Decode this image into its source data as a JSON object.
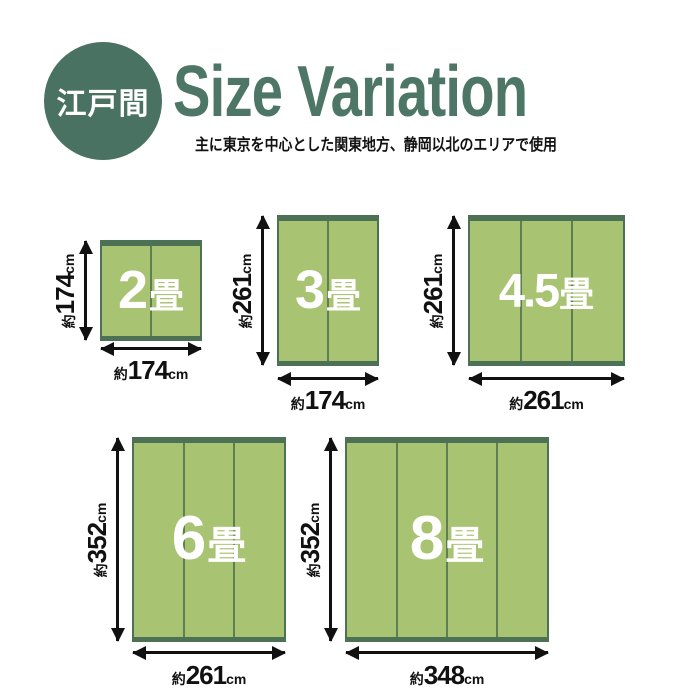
{
  "header": {
    "badge": "江戸間",
    "title": "Size Variation",
    "subtitle": "主に東京を中心とした関東地方、静岡以北のエリアで使用"
  },
  "colors": {
    "brand_green": "#4a7263",
    "title_green": "#4d7667",
    "mat_fill": "#a8c371",
    "mat_border": "#4d7154",
    "mat_divider": "#5f7f52",
    "dimension_text": "#111111",
    "mat_label_text": "#ffffff",
    "background": "#ffffff"
  },
  "mats": [
    {
      "name": "2畳",
      "num": "2",
      "unit": "畳",
      "panels": 2,
      "height": {
        "prefix": "約",
        "value": "174",
        "suffix": "cm"
      },
      "width": {
        "prefix": "約",
        "value": "174",
        "suffix": "cm"
      }
    },
    {
      "name": "3畳",
      "num": "3",
      "unit": "畳",
      "panels": 2,
      "height": {
        "prefix": "約",
        "value": "261",
        "suffix": "cm"
      },
      "width": {
        "prefix": "約",
        "value": "174",
        "suffix": "cm"
      }
    },
    {
      "name": "4.5畳",
      "num": "4.5",
      "unit": "畳",
      "panels": 3,
      "height": {
        "prefix": "約",
        "value": "261",
        "suffix": "cm"
      },
      "width": {
        "prefix": "約",
        "value": "261",
        "suffix": "cm"
      }
    },
    {
      "name": "6畳",
      "num": "6",
      "unit": "畳",
      "panels": 3,
      "height": {
        "prefix": "約",
        "value": "352",
        "suffix": "cm"
      },
      "width": {
        "prefix": "約",
        "value": "261",
        "suffix": "cm"
      }
    },
    {
      "name": "8畳",
      "num": "8",
      "unit": "畳",
      "panels": 4,
      "height": {
        "prefix": "約",
        "value": "352",
        "suffix": "cm"
      },
      "width": {
        "prefix": "約",
        "value": "348",
        "suffix": "cm"
      }
    }
  ]
}
